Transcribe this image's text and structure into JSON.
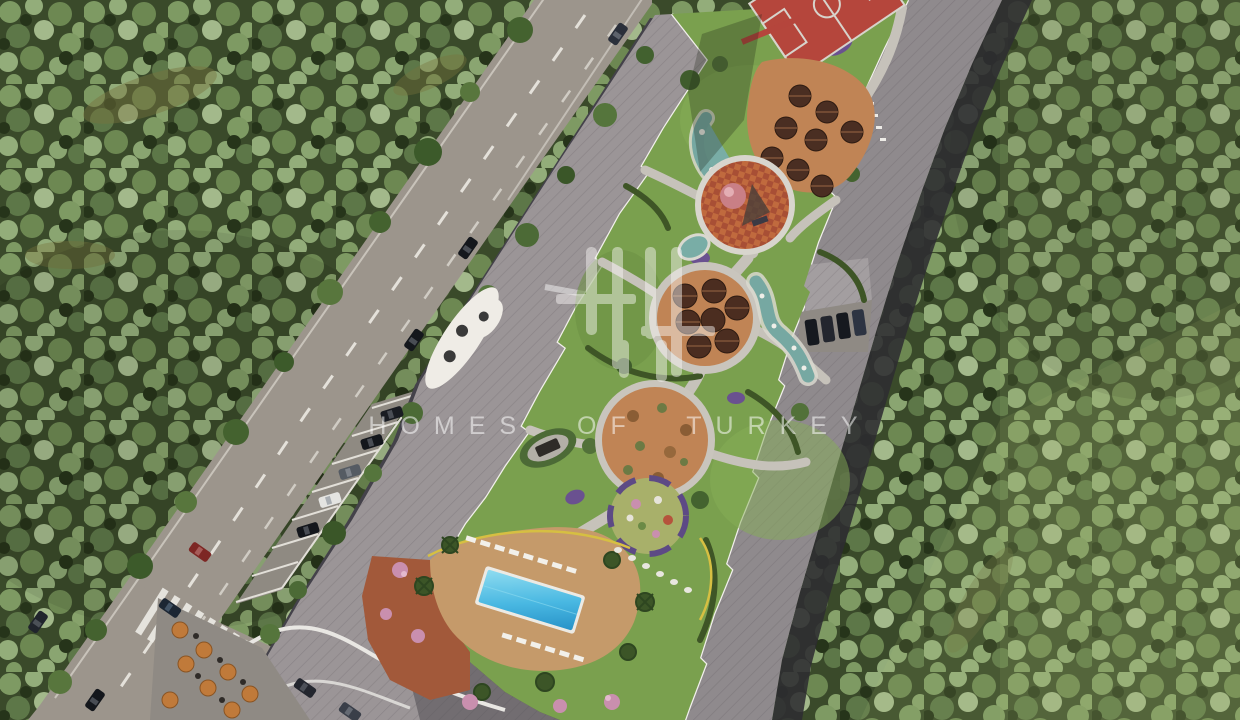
{
  "watermark": {
    "text": "HOMES OF TURKEY",
    "logo": "homes-of-turkey-columns-logo"
  },
  "scene": {
    "type": "aerial-3d-render",
    "description": "Bird's-eye architectural render of a residential complex set in dense forest: a two-lane road with angled street parking on the left, two long apartment blocks with grey roofs, and a landscaped inner courtyard with plazas, playgrounds, water features and a swimming pool.",
    "regions": [
      "forest-left",
      "forest-right",
      "main-road",
      "side-road",
      "zebra-crosswalk",
      "street-parking-row",
      "left-apartment-block",
      "right-apartment-block",
      "annex-parking",
      "basketball-court",
      "upper-terrace",
      "kids-playground",
      "upper-round-plaza",
      "pebble-stream",
      "lower-round-plaza",
      "flower-garden-circle",
      "pergola-oval",
      "swimming-pool",
      "pool-deck",
      "terracotta-patio",
      "cafe-terrace",
      "entrance-canopy"
    ],
    "counts": {
      "round-plazas": 2,
      "plaza-parasols": 7,
      "terrace-umbrellas": 8,
      "cafe-umbrellas": 8,
      "street-cars": 10,
      "parking-stall-cars": 5,
      "annex-cars": 4,
      "pools": 1,
      "basketball-courts": 1
    }
  },
  "palette": {
    "forestBase": "#3a4a2a",
    "road": "#9c958c",
    "roofLeft": "#9b9597",
    "roofRight": "#8f8a8d",
    "lawn": "#7aa04e",
    "path": "#c6c2ba",
    "pool": "#3fb6e0",
    "deck": "#c59a6a",
    "terracotta": "#a2593a",
    "plazaOrange": "#c08455",
    "water": "#79ada6",
    "purple": "#6a5190",
    "courtRed": "#b5463c",
    "shadowDark": "#2e2c31",
    "watermark": "#ffffff"
  }
}
